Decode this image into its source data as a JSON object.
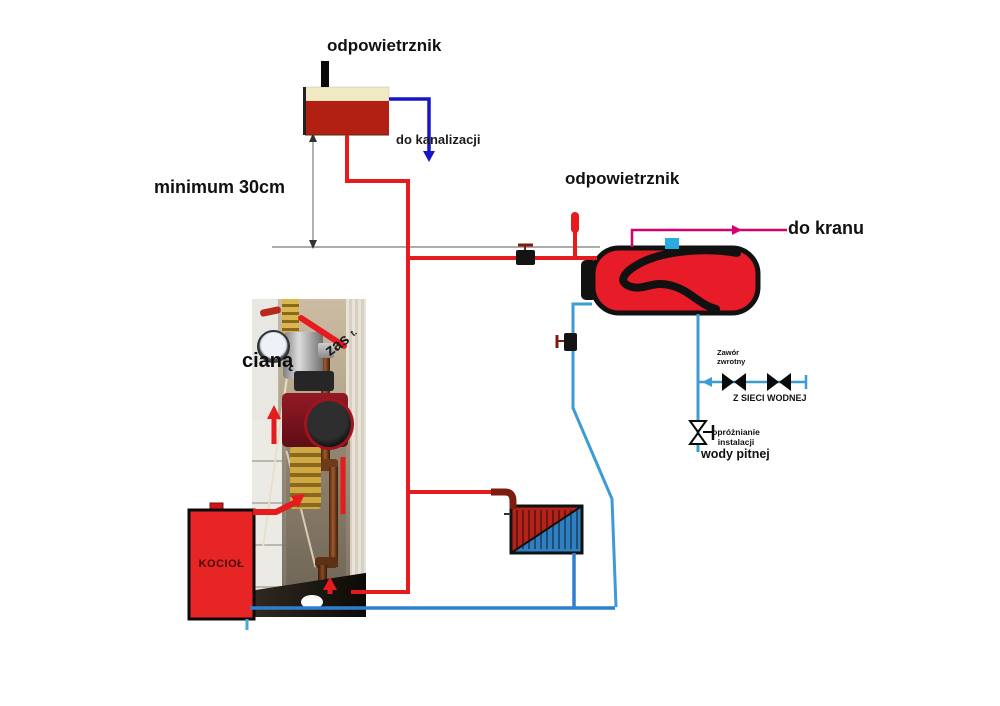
{
  "diagram": {
    "top_tank": {
      "label_air_vent": "odpowietrznik",
      "label_to_sewer": "do kanalizacji",
      "label_min_height": "minimum 30cm"
    },
    "dhw_tank": {
      "label_air_vent": "odpowietrznik",
      "label_to_tap": "do kranu"
    },
    "water_supply": {
      "label_check_valve": "Zawór\nzwrotny",
      "label_mains": "Z SIECI WODNEJ",
      "label_drain": "opróżnianie\ninstalacji",
      "label_drain_bold": "wody pitnej"
    },
    "boiler": {
      "label": "KOCIOŁ"
    },
    "photo": {
      "overlay_wall": "cianą",
      "overlay_diagonal": "zas",
      "overlay_corner": "t."
    },
    "colors": {
      "pipe_hot": "#e51b1e",
      "pipe_hot_dark": "#7d1d10",
      "pipe_cold_light": "#3d9bd5",
      "pipe_cold": "#2e7fd0",
      "pipe_sewer": "#1616c8",
      "pipe_tap": "#d6006e",
      "tank_red": "#e81b28",
      "tank_cream": "#f0e9c4",
      "tank_brick": "#b22014",
      "boiler_red": "#e82525",
      "inlet_blue": "#29abe2",
      "dimension_gray": "#909090"
    }
  }
}
